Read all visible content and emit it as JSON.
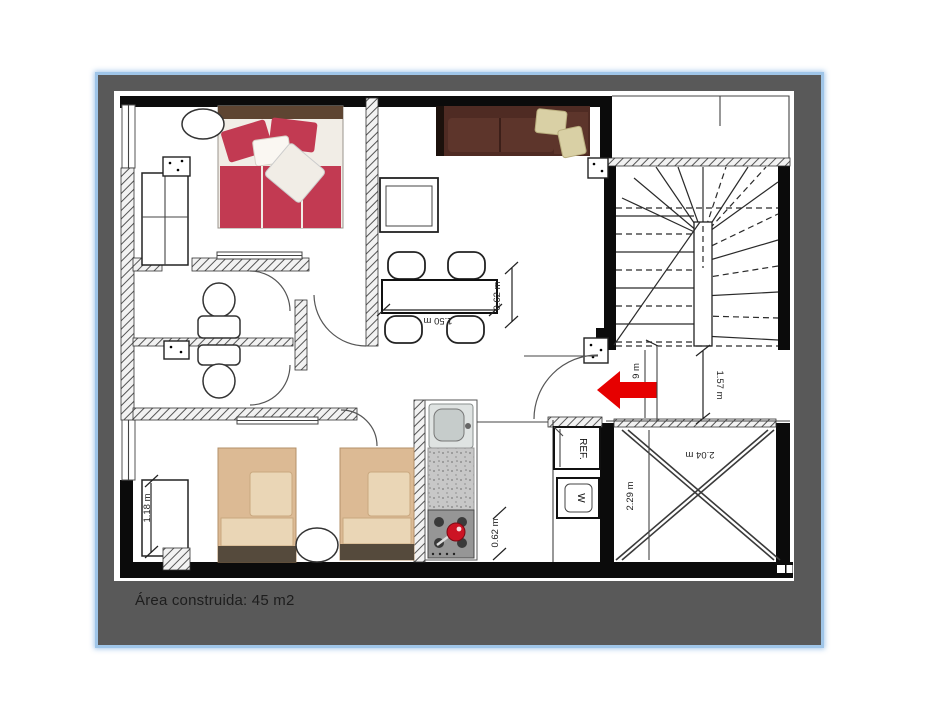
{
  "colors": {
    "panel-bg": "#595959",
    "panel-border": "#9fc5e8",
    "caption-color": "#1d1d1d",
    "arrow-red": "#e60000",
    "bed-red": "#c23a52",
    "sheet-white": "#f1ede6",
    "headboard-brown": "#5e4532",
    "sofa-brown": "#4f2b23",
    "sofa-seat": "#5d352b",
    "cushion-beige": "#d9d0a5",
    "bed-tan": "#dcba94",
    "bed-tan-light": "#ead6b6",
    "bed-foot": "#554a3c",
    "counter-gray": "#c7c7c7",
    "stove-gray": "#969696",
    "pot-red": "#cc1324"
  },
  "caption": {
    "text": "Área construida: 45 m2"
  },
  "labels": {
    "fridge": "REF.",
    "washer": "W"
  },
  "dimensions": {
    "dining_table_length": "1.50 m",
    "dining_table_width": "0.62 m",
    "entry_width_partial": "9 m",
    "stair_landing": "1.57 m",
    "patio_width": "2.04 m",
    "patio_depth": "2.29 m",
    "closet_width": "1.18 m",
    "kitchen_depth": "0.62 m"
  },
  "furniture_icons": [
    "double-bed-icon",
    "nightstand-icon",
    "wardrobe-icon",
    "toilet-icon",
    "sofa-icon",
    "desk-icon",
    "dining-table-icon",
    "chair-icon",
    "single-bed-icon",
    "side-table-icon",
    "kitchen-sink-icon",
    "kitchen-counter-icon",
    "stove-icon",
    "fridge-icon",
    "washer-icon",
    "stairs-icon",
    "patio-cross-icon",
    "entrance-arrow-icon"
  ]
}
